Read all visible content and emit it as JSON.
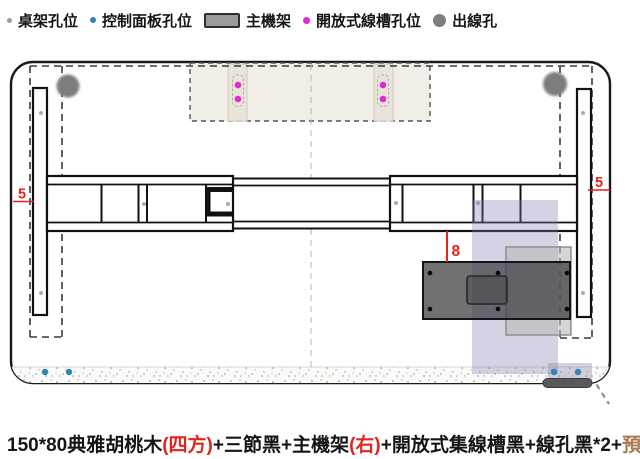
{
  "legend": {
    "items": [
      {
        "label": "桌架孔位",
        "marker": "small-gray-dot",
        "color": "#9b9b9b"
      },
      {
        "label": "控制面板孔位",
        "marker": "blue-dot",
        "color": "#2f86b8"
      },
      {
        "label": "主機架",
        "marker": "gray-rect",
        "color": "#9b9b9b"
      },
      {
        "label": "開放式線槽孔位",
        "marker": "magenta-dot",
        "color": "#e02ad2"
      },
      {
        "label": "出線孔",
        "marker": "large-gray-dot",
        "color": "#7f7f7f"
      }
    ]
  },
  "dimensions": {
    "left_edge_gap": "5",
    "right_edge_gap": "5",
    "main_unit_offset": "8"
  },
  "caption": {
    "segments": [
      {
        "text": "150*80典雅胡桃木",
        "color": "#151515"
      },
      {
        "text": "(四方)",
        "color": "#e3241c"
      },
      {
        "text": "+三節黑+主機架",
        "color": "#151515"
      },
      {
        "text": "(右)",
        "color": "#e3241c"
      },
      {
        "text": "+開放式集線槽黑+線孔黑*2+",
        "color": "#151515"
      },
      {
        "text": "預埋螺母",
        "color": "#a87a4f"
      }
    ]
  },
  "colors": {
    "desk_outline": "#1a1a1a",
    "dashed_frame": "#3a3a3a",
    "dimension_red": "#e3241c",
    "desk_frame_hole": "#ababab",
    "control_panel_hole": "#2f86b8",
    "cable_tray_hole": "#e02ad2",
    "cable_outlet": "#7d7d7d",
    "main_unit_fill": "#3f3f44",
    "cable_tray_fill": "#f1ede7",
    "purple_overlay": "#8978af"
  },
  "counts": {
    "cable_outlet_holes": 2,
    "control_panel_holes": 4,
    "cable_tray_holes": 4,
    "main_unit_screw_holes": 6
  }
}
